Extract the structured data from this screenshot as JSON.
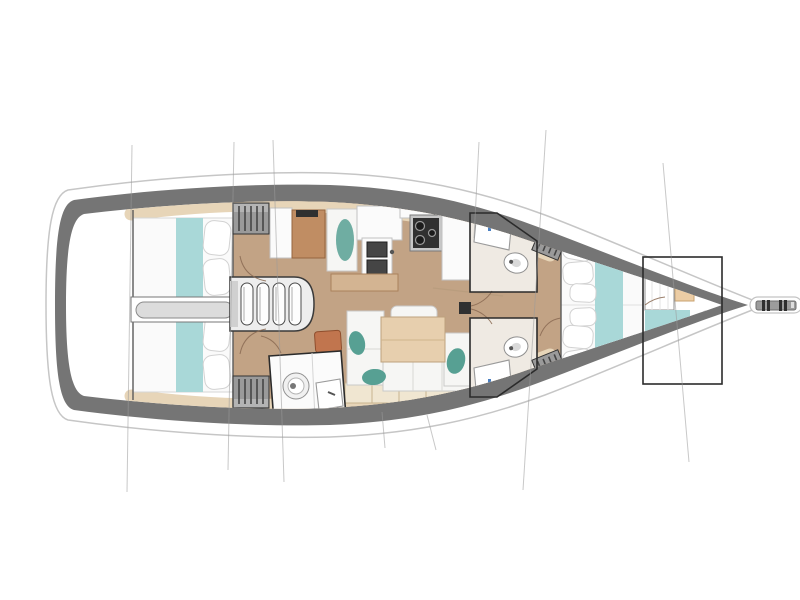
{
  "diagram": {
    "label": "Sailing yacht interior layout floor plan, top view, bow pointing right",
    "type": "boat-floor-plan",
    "features": [
      "aft port cabin with double berth and hanging locker",
      "aft starboard cabin with double berth and hanging locker",
      "engine compartment between aft cabins",
      "companionway steps with four treads",
      "navigation station with chart table and seat",
      "aft bathroom with toilet and sink",
      "galley with twin sinks, two-burner stove and counters",
      "salon with U-shaped settee, table and ottoman",
      "port midship head with sink and toilet",
      "starboard midship head with sink and toilet",
      "mast post",
      "forward master cabin with double berth and hanging lockers",
      "forepeak compartment with berth, vanity, toilet and sink",
      "bowsprit with anchor roller",
      "standing rigging lines crossing the plan"
    ]
  },
  "colors": {
    "hull_band": "#757575",
    "hull_rim": "#c6c6c6",
    "interior": "#ffffff",
    "floor": "#c2a385",
    "shelf": "#e7d5b8",
    "mattress": "#fafafa",
    "mattress_edge": "#d6d6d6",
    "teal": "#a9d8d8",
    "teal_dark": "#57a093",
    "desk": "#c08d63",
    "table": "#e7cfae",
    "bar": "#d3b492",
    "ottoman": "#c1754e",
    "locker": "#9a9a9a",
    "locker_stripe": "#454545",
    "border": "#2b2b2b",
    "engine": "#dcdcdc",
    "cushion": "#f6f6f4",
    "cushion_back": "#f0e6d1",
    "head_floor": "#efeae3",
    "arc": "#8a6a52",
    "rig": "#9b9b9b",
    "appliance": "#303030",
    "fixture_stroke": "#9a9a9a",
    "bowsprit": "#9c9c9c"
  }
}
